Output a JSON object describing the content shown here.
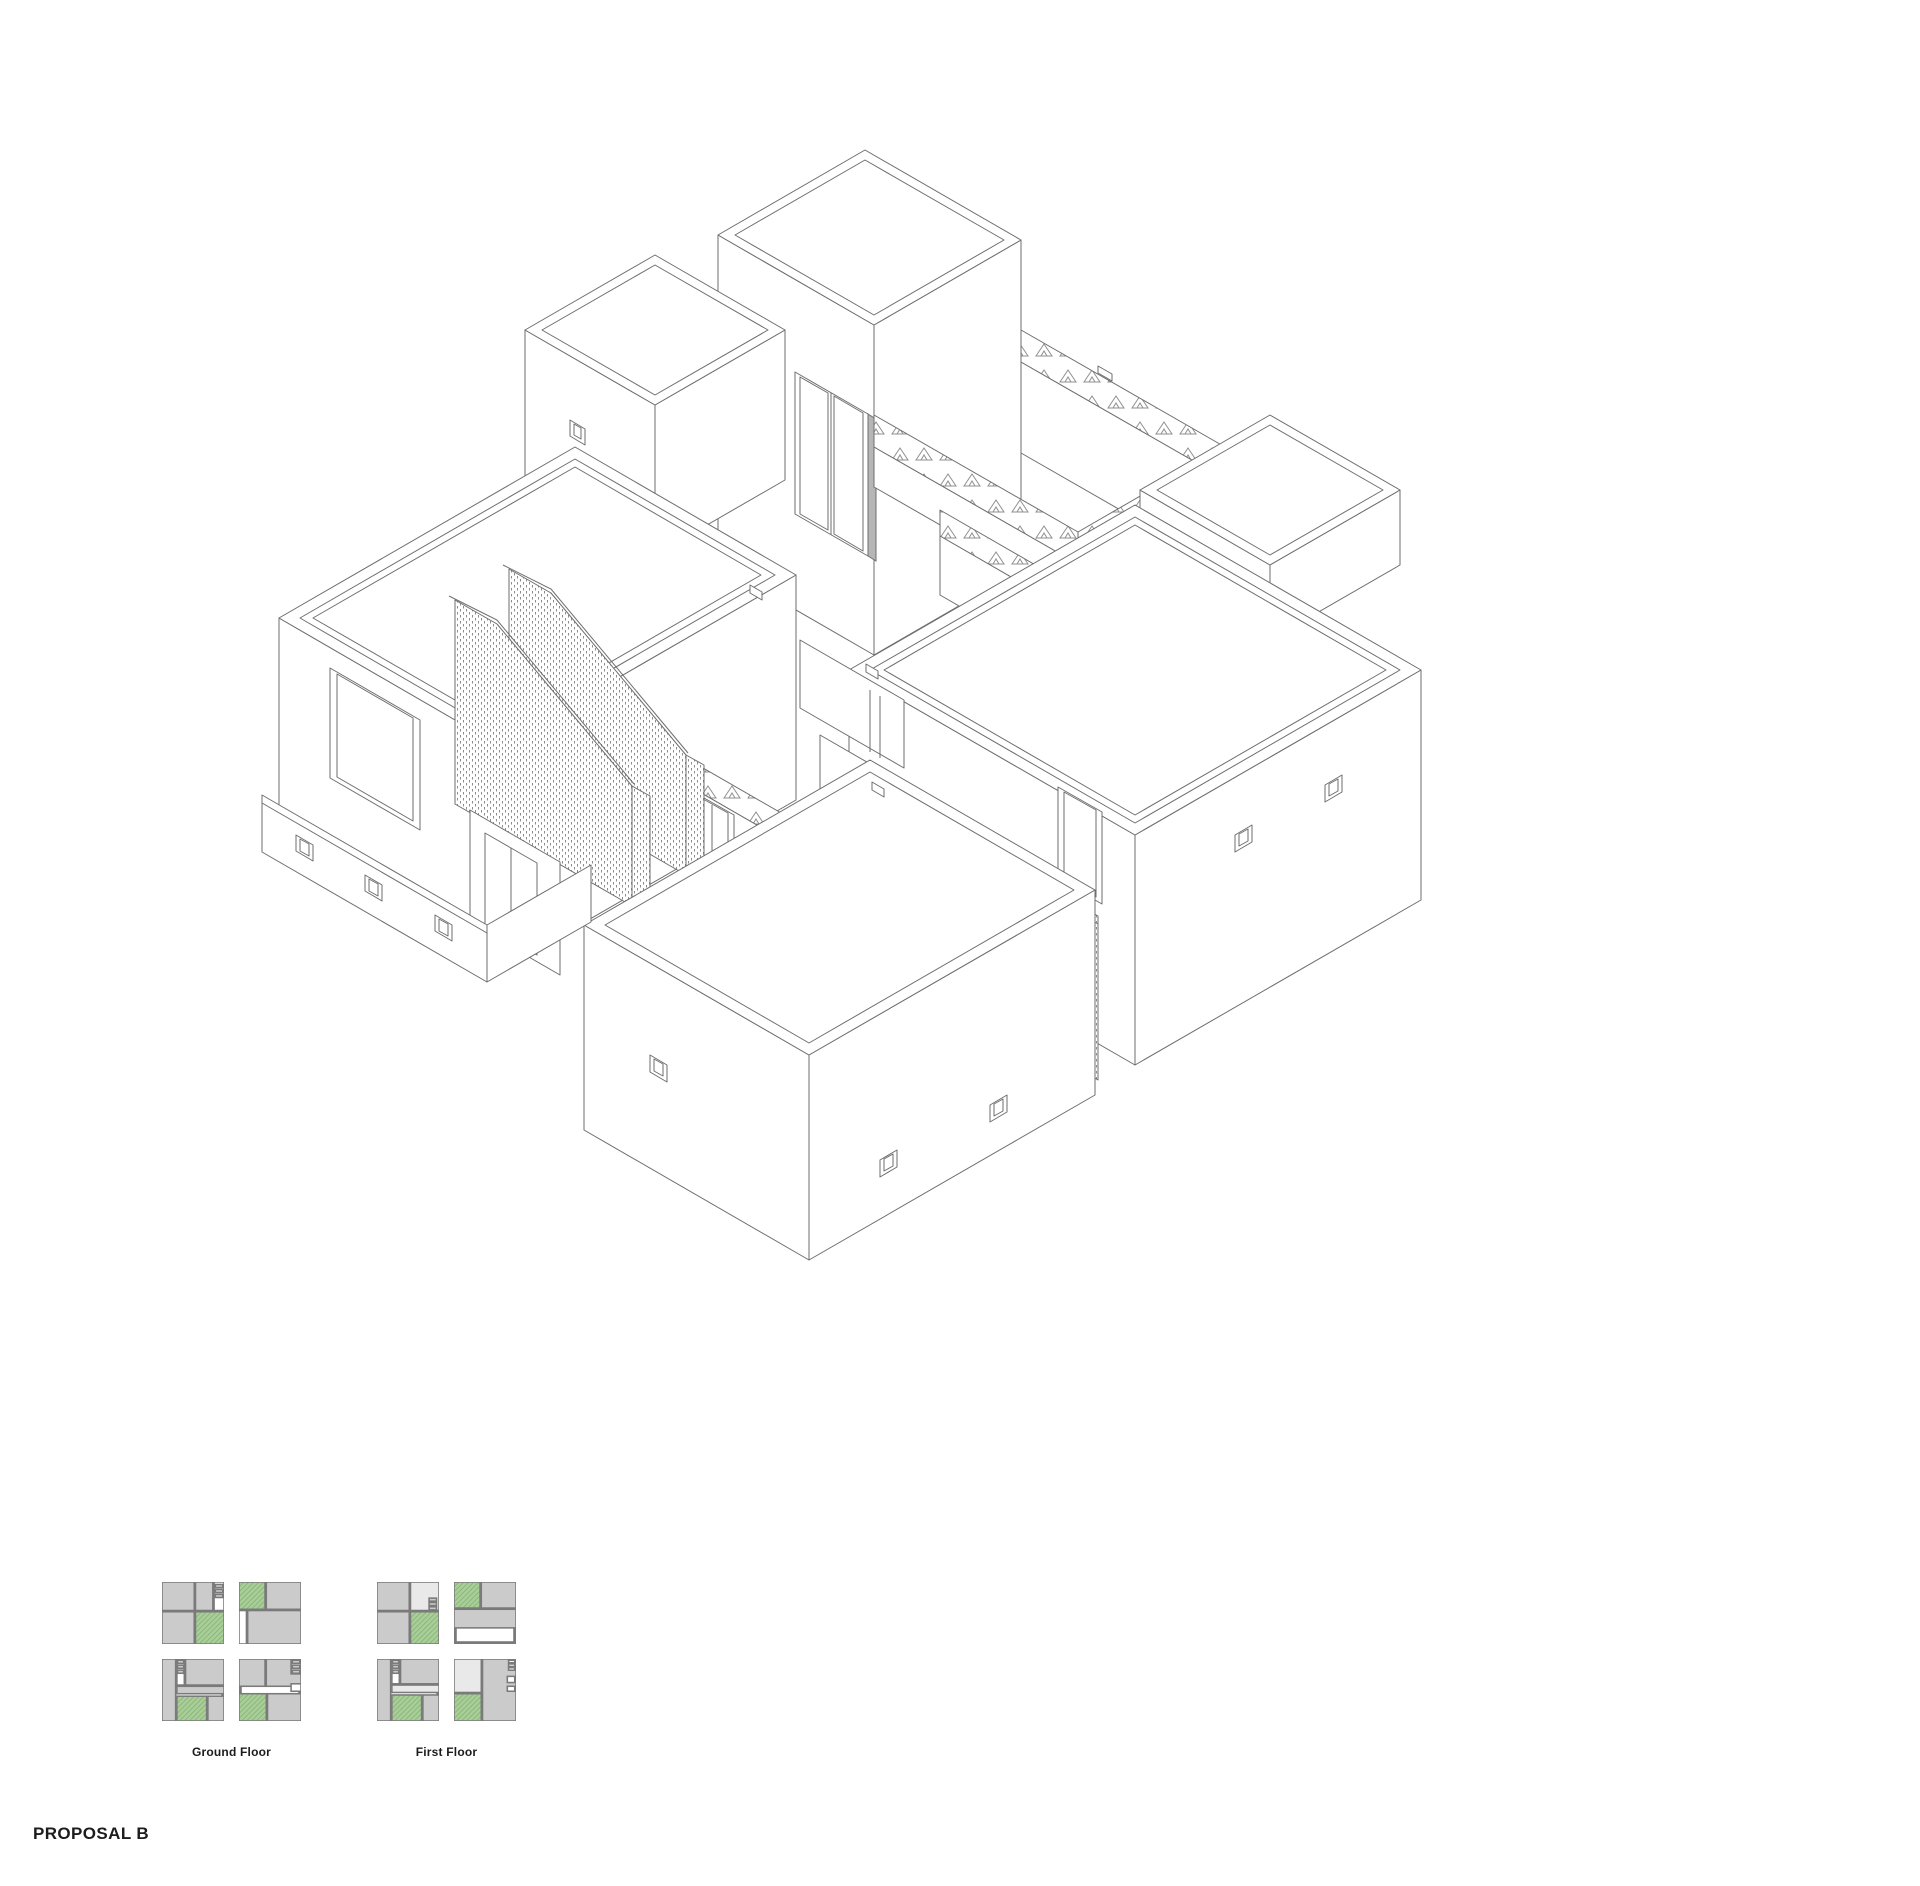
{
  "title": {
    "label": "PROPOSAL B"
  },
  "colors": {
    "line": "#6e6e6e",
    "text": "#1c1c1c",
    "plan_gray": "#cbcbcb",
    "plan_border": "#7a7a7a",
    "plan_green": "#a8cf98",
    "plan_green_hatch": "#84ab72",
    "plan_light": "#e9e9e9",
    "plan_white": "#ffffff"
  },
  "legend": {
    "plan_size": 62,
    "gap": 15,
    "label_offset": 24,
    "groups": [
      {
        "label": "Ground Floor",
        "x": 162,
        "y": 1582,
        "plans": [
          {
            "rects": [
              [
                "g",
                0,
                0,
                52,
                46
              ],
              [
                "g",
                54,
                0,
                28,
                46
              ],
              [
                "w",
                84,
                0,
                16,
                46
              ],
              [
                "g",
                86,
                4,
                12,
                5
              ],
              [
                "g",
                86,
                12,
                12,
                5
              ],
              [
                "g",
                86,
                20,
                12,
                5
              ],
              [
                "g",
                0,
                48,
                52,
                52
              ],
              [
                "n",
                54,
                48,
                46,
                52
              ]
            ]
          },
          {
            "rects": [
              [
                "n",
                0,
                0,
                42,
                44
              ],
              [
                "g",
                44,
                0,
                56,
                44
              ],
              [
                "w",
                0,
                46,
                12,
                54
              ],
              [
                "g",
                14,
                46,
                86,
                54
              ]
            ]
          },
          {
            "rects": [
              [
                "g",
                0,
                0,
                22,
                100
              ],
              [
                "w",
                24,
                0,
                12,
                42
              ],
              [
                "g",
                25,
                2,
                10,
                5
              ],
              [
                "g",
                25,
                10,
                10,
                5
              ],
              [
                "g",
                25,
                18,
                10,
                5
              ],
              [
                "g",
                38,
                0,
                62,
                42
              ],
              [
                "g",
                24,
                44,
                76,
                12
              ],
              [
                "n",
                24,
                60,
                48,
                40
              ],
              [
                "g",
                74,
                60,
                26,
                40
              ]
            ]
          },
          {
            "rects": [
              [
                "g",
                0,
                0,
                42,
                44
              ],
              [
                "g",
                44,
                0,
                56,
                44
              ],
              [
                "w",
                84,
                0,
                16,
                24
              ],
              [
                "g",
                86,
                2,
                12,
                5
              ],
              [
                "g",
                86,
                10,
                12,
                5
              ],
              [
                "g",
                86,
                18,
                12,
                5
              ],
              [
                "w",
                84,
                40,
                16,
                12
              ],
              [
                "n",
                0,
                56,
                44,
                44
              ],
              [
                "g",
                46,
                56,
                54,
                44
              ]
            ]
          }
        ]
      },
      {
        "label": "First Floor",
        "x": 377,
        "y": 1582,
        "plans": [
          {
            "rects": [
              [
                "g",
                0,
                0,
                52,
                46
              ],
              [
                "l",
                54,
                0,
                46,
                46
              ],
              [
                "g",
                84,
                26,
                12,
                5
              ],
              [
                "g",
                84,
                33,
                12,
                5
              ],
              [
                "g",
                84,
                40,
                12,
                5
              ],
              [
                "g",
                0,
                48,
                52,
                52
              ],
              [
                "n",
                54,
                48,
                46,
                52
              ]
            ]
          },
          {
            "rects": [
              [
                "n",
                0,
                0,
                42,
                42
              ],
              [
                "g",
                44,
                0,
                56,
                42
              ],
              [
                "g",
                0,
                44,
                100,
                30
              ]
            ]
          },
          {
            "rects": [
              [
                "g",
                0,
                0,
                22,
                100
              ],
              [
                "w",
                24,
                0,
                12,
                40
              ],
              [
                "g",
                25,
                2,
                10,
                5
              ],
              [
                "g",
                25,
                10,
                10,
                5
              ],
              [
                "g",
                25,
                18,
                10,
                5
              ],
              [
                "g",
                38,
                0,
                62,
                40
              ],
              [
                "l",
                24,
                42,
                76,
                12
              ],
              [
                "n",
                24,
                58,
                48,
                42
              ],
              [
                "g",
                74,
                58,
                26,
                42
              ]
            ]
          },
          {
            "rects": [
              [
                "l",
                0,
                0,
                44,
                54
              ],
              [
                "g",
                46,
                0,
                54,
                100
              ],
              [
                "w",
                88,
                2,
                10,
                4
              ],
              [
                "w",
                88,
                8,
                10,
                4
              ],
              [
                "w",
                88,
                14,
                10,
                4
              ],
              [
                "w",
                86,
                28,
                12,
                10
              ],
              [
                "w",
                86,
                44,
                12,
                8
              ],
              [
                "n",
                0,
                56,
                44,
                44
              ]
            ]
          }
        ]
      }
    ]
  }
}
